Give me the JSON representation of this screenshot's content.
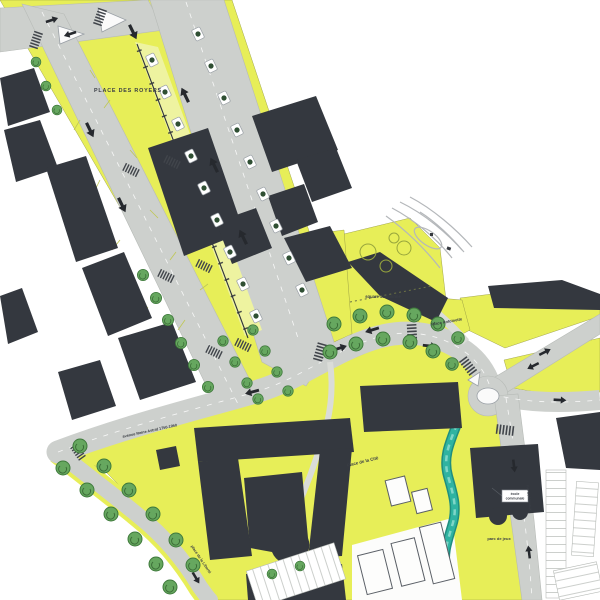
{
  "map": {
    "labels": {
      "place_des_royers": "PLACE DES ROYERS",
      "square_jamblinne": "square Jamblinne",
      "place_antoinette": "Place Antoinette",
      "place_de_la_cite": "Place de la Cité",
      "parc_de_jeux": "parc de jeux",
      "avenue": "avenue Reine Astrid 1750-1950",
      "place_liberte": "place de la Liberté",
      "rue_navaux": "rue de Navaux",
      "note_line1": "école",
      "note_line2": "communale"
    },
    "colors": {
      "yellow": "#e7ee58",
      "yellow_pale": "#eef3a0",
      "building": "#34383f",
      "road": "#cdd0cd",
      "road_edge": "#b7bbb7",
      "tree_fill": "#66a75f",
      "tree_stroke": "#3f7a3c",
      "water": "#2fb3a1",
      "sketch": "#b4b7ba",
      "marking": "#41454b",
      "text": "#3a3e45"
    }
  }
}
